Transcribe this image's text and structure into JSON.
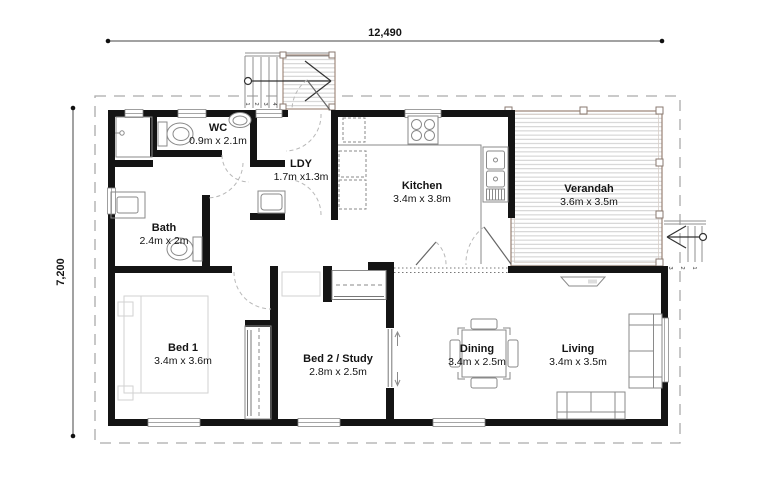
{
  "plan": {
    "dimensions": {
      "width": "12,490",
      "height": "7,200"
    },
    "rooms": [
      {
        "id": "wc",
        "name": "WC",
        "size": "0.9m x 2.1m"
      },
      {
        "id": "ldy",
        "name": "LDY",
        "size": "1.7m x1.3m"
      },
      {
        "id": "bath",
        "name": "Bath",
        "size": "2.4m x 2m"
      },
      {
        "id": "kitchen",
        "name": "Kitchen",
        "size": "3.4m x 3.8m"
      },
      {
        "id": "verandah",
        "name": "Verandah",
        "size": "3.6m x 3.5m"
      },
      {
        "id": "bed1",
        "name": "Bed 1",
        "size": "3.4m x 3.6m"
      },
      {
        "id": "bed2",
        "name": "Bed 2 / Study",
        "size": "2.8m x 2.5m"
      },
      {
        "id": "dining",
        "name": "Dining",
        "size": "3.4m x 2.5m"
      },
      {
        "id": "living",
        "name": "Living",
        "size": "3.4m x 3.5m"
      }
    ],
    "steps": {
      "top": [
        "1",
        "2",
        "3",
        "4"
      ],
      "right": [
        "3",
        "2",
        "1"
      ]
    },
    "icons": {
      "toilet-icon": "tank+bowl ellipse",
      "basin-icon": "oval basin",
      "vanity-icon": "rect with inset sink",
      "shower-icon": "corner cubicle with tap",
      "washer-icon": "square with drum",
      "cooktop-icon": "four rings",
      "sink-icon": "double basin with drainer",
      "robe-icon": "strip with hanging rail",
      "bed-icon": "faint rectangle",
      "sofa-icon": "outline with cushions",
      "dining-table-icon": "square table, four chairs",
      "stairs-arrow-icon": "circle shaft chevron"
    },
    "colors": {
      "wall": "#141414",
      "deck_frame": "#9a8274",
      "deck_board": "#c9c9c9",
      "roof_dash": "#ababab",
      "door_arc": "#b8b8b8",
      "text": "#141414"
    }
  }
}
